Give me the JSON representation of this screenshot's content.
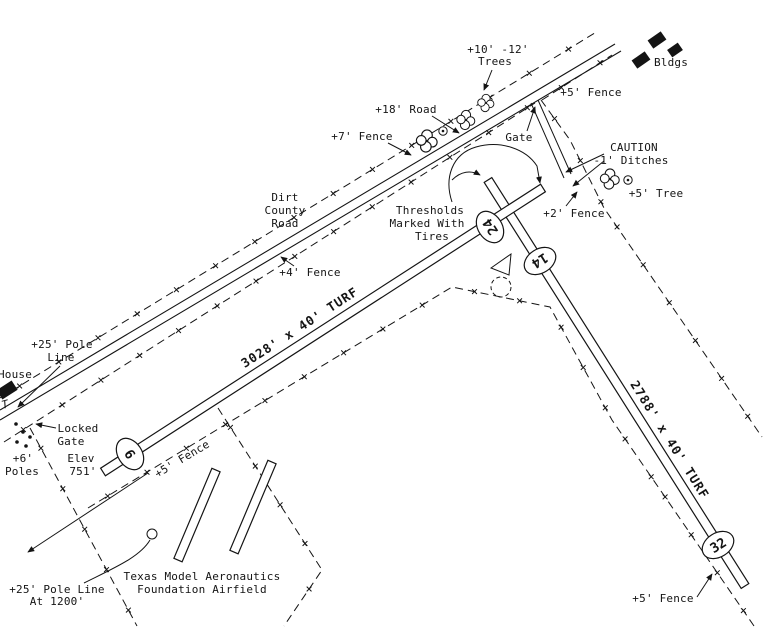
{
  "page": {
    "background": "#ffffff",
    "ink_color": "#141414"
  },
  "airfield": {
    "name_line1": "Texas Model Aeronautics",
    "name_line2": "Foundation Airfield",
    "elevation": {
      "line1": "Elev",
      "line2": "751'"
    },
    "runways": [
      {
        "id": "6-24",
        "size_label": "3028' x 40'  TURF",
        "end_a": "6",
        "end_b": "24",
        "surface": "TURF"
      },
      {
        "id": "14-32",
        "size_label": "2788' x 40'  TURF",
        "end_a": "14",
        "end_b": "32",
        "surface": "TURF"
      }
    ]
  },
  "annotations": {
    "trees_l1": "+10' -12'",
    "trees_l2": "Trees",
    "bldgs": "Bldgs",
    "fence5_top": "+5' Fence",
    "road18": "+18' Road",
    "fence7": "+7' Fence",
    "gate_top": "Gate",
    "caution_l1": "CAUTION",
    "caution_l2": "-1' Ditches",
    "tree5": "+5' Tree",
    "fence2": "+2' Fence",
    "dirt_road_l1": "Dirt",
    "dirt_road_l2": "County",
    "dirt_road_l3": "Road",
    "thresholds_l1": "Thresholds",
    "thresholds_l2": "Marked With",
    "thresholds_l3": "Tires",
    "fence4": "+4' Fence",
    "pole25_l1": "+25' Pole",
    "pole25_l2": "Line",
    "house": "House",
    "pole_t": "T",
    "locked_l1": "Locked",
    "locked_l2": "Gate",
    "poles6_l1": "+6'",
    "poles6_l2": "Poles",
    "fence5_mid": "+5' Fence",
    "pole25b_l1": "+25' Pole Line",
    "pole25b_l2": "At 1200'",
    "fence5_br": "+5' Fence"
  },
  "icons": {
    "tree_icon": "cloud-scallop tree symbol",
    "tree_dot_icon": "circled-dot tree symbol",
    "windsock_icon": "dashed circle with tetrahedron",
    "building_icon": "filled black rectangle",
    "pole_icon": "filled dot"
  }
}
